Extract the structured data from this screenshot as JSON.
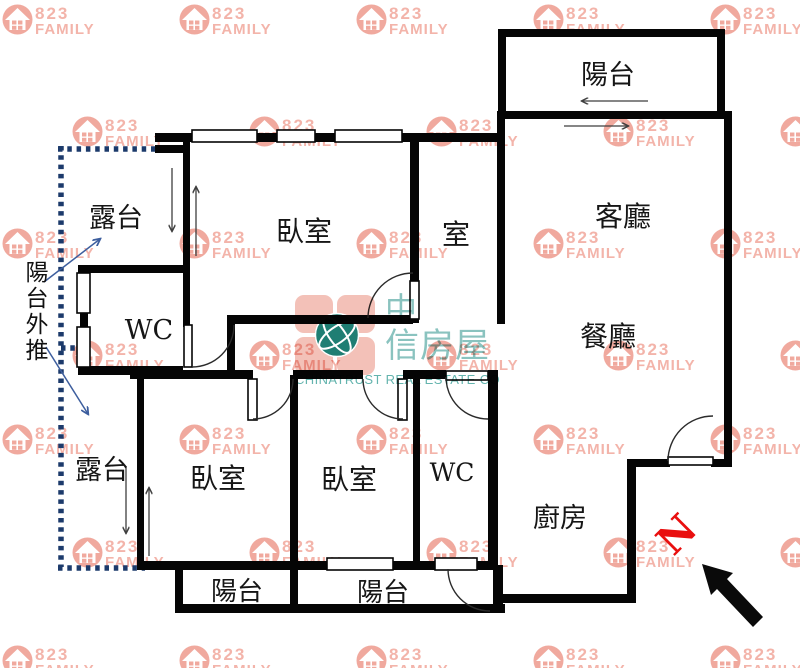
{
  "watermark": {
    "number": "823",
    "name": "FAMILY"
  },
  "brand_logo": {
    "cjk_first": "中",
    "cjk_rest": "信房屋",
    "latin": "CHINATRUST REAL ESTATE CO"
  },
  "compass": {
    "north_label": "N"
  },
  "rooms": {
    "balcony_top": "陽台",
    "living_room": "客廳",
    "dining_room": "餐廳",
    "terrace_upper": "露台",
    "bedroom_top": "臥室",
    "small_room": "室",
    "wc_upper": "WC",
    "balcony_push_out_note": "陽台外推",
    "terrace_lower": "露台",
    "bedroom_bottom_left": "臥室",
    "bedroom_bottom_middle": "臥室",
    "wc_lower": "WC",
    "kitchen": "廚房",
    "balcony_bottom_left": "陽台",
    "balcony_bottom_middle": "陽台"
  },
  "colors": {
    "wall": "#050505",
    "push_out_dotted_line": "#1c3a6b",
    "annotation_arrow_blue": "#3d5e9e",
    "flow_arrow_gray": "#3f3f3f",
    "north_letter_red": "#e90f0f",
    "watermark_salmon": "#f2aca1",
    "logo_teal": "#8ac3bf",
    "logo_pink": "#f3c1b8"
  }
}
